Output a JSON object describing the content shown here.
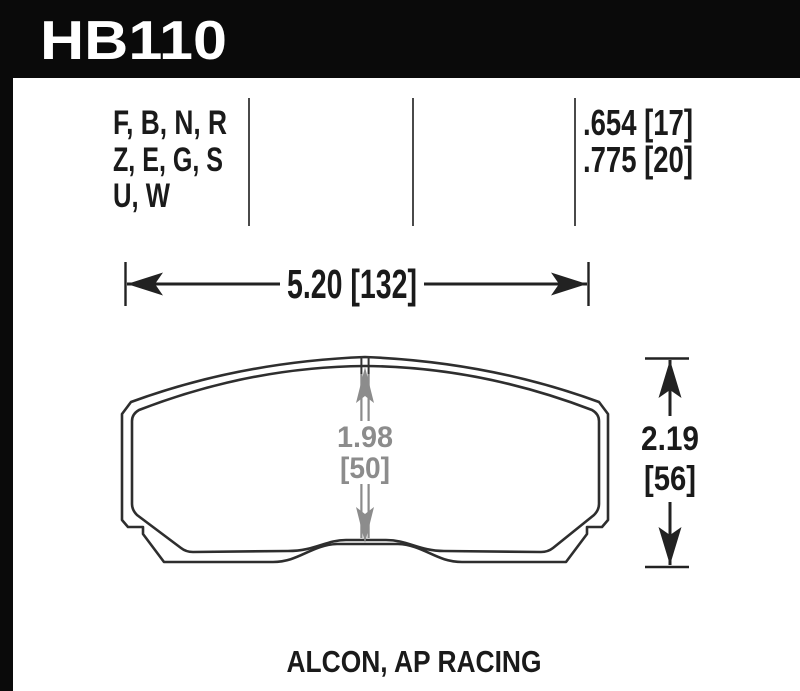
{
  "header": {
    "part_number": "HB110",
    "bg_color": "#0a0a0a",
    "text_color": "#ffffff"
  },
  "compound_table": {
    "compound_lines": [
      "F, B, N, R",
      "Z, E, G, S",
      "U, W"
    ],
    "thickness_values": [
      ".654 [17]",
      ".775 [20]"
    ]
  },
  "dimensions": {
    "overall_width": "5.20 [132]",
    "overall_height_in": "2.19",
    "overall_height_mm": "[56]",
    "pad_height_in": "1.98",
    "pad_height_mm": "[50]"
  },
  "caption": "ALCON, AP RACING",
  "colors": {
    "line_color": "#2e2e2e",
    "text_color": "#1a1a1a",
    "gray_dimension_color": "#8c8c8c",
    "header_bg": "#0a0a0a"
  }
}
